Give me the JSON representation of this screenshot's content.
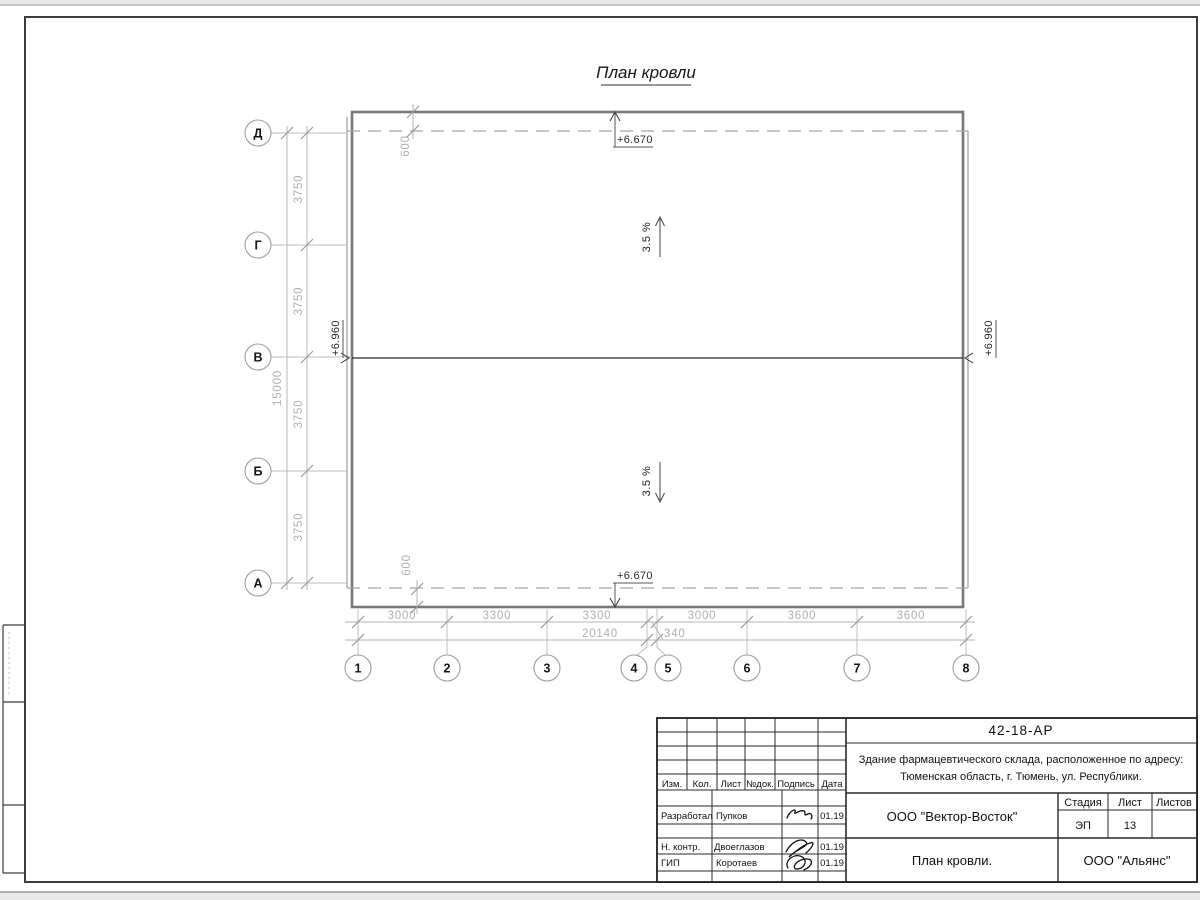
{
  "sheet": {
    "drawing_title": "План кровли"
  },
  "plan": {
    "elevation_top": "+6.670",
    "elevation_bottom": "+6.670",
    "elevation_left": "+6.960",
    "elevation_right": "+6.960",
    "slope_up": "3.5 %",
    "slope_down": "3.5 %",
    "overhang_top": "600",
    "overhang_bottom": "600",
    "row_axes": [
      "Д",
      "Г",
      "В",
      "Б",
      "А"
    ],
    "col_axes": [
      "1",
      "2",
      "3",
      "4",
      "5",
      "6",
      "7",
      "8"
    ],
    "left_dims": [
      "3750",
      "3750",
      "3750",
      "3750"
    ],
    "left_total": "15000",
    "bottom_dims": [
      "3000",
      "3300",
      "3300",
      "3000",
      "3600",
      "3600"
    ],
    "bottom_small_dim": "340",
    "bottom_total": "20140"
  },
  "title_block": {
    "doc_code": "42-18-АР",
    "project_line1": "Здание фармацевтического склада, расположенное по адресу:",
    "project_line2": "Тюменская область, г. Тюмень, ул. Республики.",
    "columns": [
      "Изм.",
      "Кол.",
      "Лист",
      "№док.",
      "Подпись",
      "Дата"
    ],
    "signers": [
      {
        "role": "Разработал",
        "name": "Пупков",
        "date": "01.19"
      },
      {
        "role": "Н. контр.",
        "name": "Двоеглазов",
        "date": "01.19"
      },
      {
        "role": "ГИП",
        "name": "Коротаев",
        "date": "01.19"
      }
    ],
    "designer_org": "ООО \"Вектор-Восток\"",
    "stage_label": "Стадия",
    "sheet_label": "Лист",
    "sheets_label": "Листов",
    "stage_value": "ЭП",
    "sheet_value": "13",
    "sheet_title": "План кровли.",
    "customer_org": "ООО \"Альянс\""
  }
}
